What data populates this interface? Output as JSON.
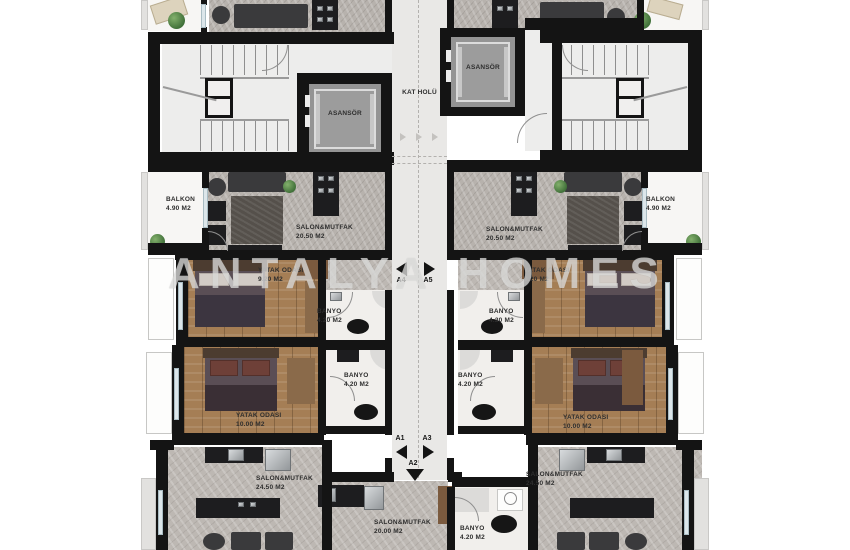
{
  "watermark": "ANTALYA HOMES",
  "core": {
    "hall_label": "KAT HOLÜ",
    "elevator_left_label": "ASANSÖR",
    "elevator_right_label": "ASANSÖR"
  },
  "markers": [
    {
      "id": "A4",
      "direction": "left"
    },
    {
      "id": "A5",
      "direction": "right"
    },
    {
      "id": "A1",
      "direction": "left"
    },
    {
      "id": "A3",
      "direction": "right"
    },
    {
      "id": "A2",
      "direction": "down"
    }
  ],
  "rooms": {
    "balkon_left": {
      "name": "BALKON",
      "area": "4.90 M2"
    },
    "balkon_right": {
      "name": "BALKON",
      "area": "4.90 M2"
    },
    "salon_mid_left": {
      "name": "SALON&MUTFAK",
      "area": "20.50 M2"
    },
    "salon_mid_right": {
      "name": "SALON&MUTFAK",
      "area": "20.50 M2"
    },
    "yatak_small_left": {
      "name": "YATAK ODASI",
      "area": "9.20 M2"
    },
    "yatak_small_right": {
      "name": "YATAK ODASI",
      "area": "9.20 M2"
    },
    "banyo_a4": {
      "name": "BANYO",
      "area": "4.20 M2"
    },
    "banyo_a5": {
      "name": "BANYO",
      "area": "4.20 M2"
    },
    "banyo_a1": {
      "name": "BANYO",
      "area": "4.20 M2"
    },
    "banyo_a3": {
      "name": "BANYO",
      "area": "4.20 M2"
    },
    "banyo_a2": {
      "name": "BANYO",
      "area": "4.20 M2"
    },
    "yatak_big_left": {
      "name": "YATAK ODASI",
      "area": "10.00 M2"
    },
    "yatak_big_right": {
      "name": "YATAK ODASI",
      "area": "10.00 M2"
    },
    "salon_bottom_left": {
      "name": "SALON&MUTFAK",
      "area": "24.50 M2"
    },
    "salon_bottom_right": {
      "name": "SALON&MUTFAK",
      "area": "24.50 M2"
    },
    "salon_bottom_center": {
      "name": "SALON&MUTFAK",
      "area": "20.00 M2"
    }
  },
  "colors": {
    "wall": "#141414",
    "stone_floor": "#b7b2ad",
    "wood_floor": "#a57e55",
    "hall_floor": "#e9e8e6",
    "plant": "#4f7d44",
    "watermark": "rgba(233,233,231,0.68)"
  }
}
